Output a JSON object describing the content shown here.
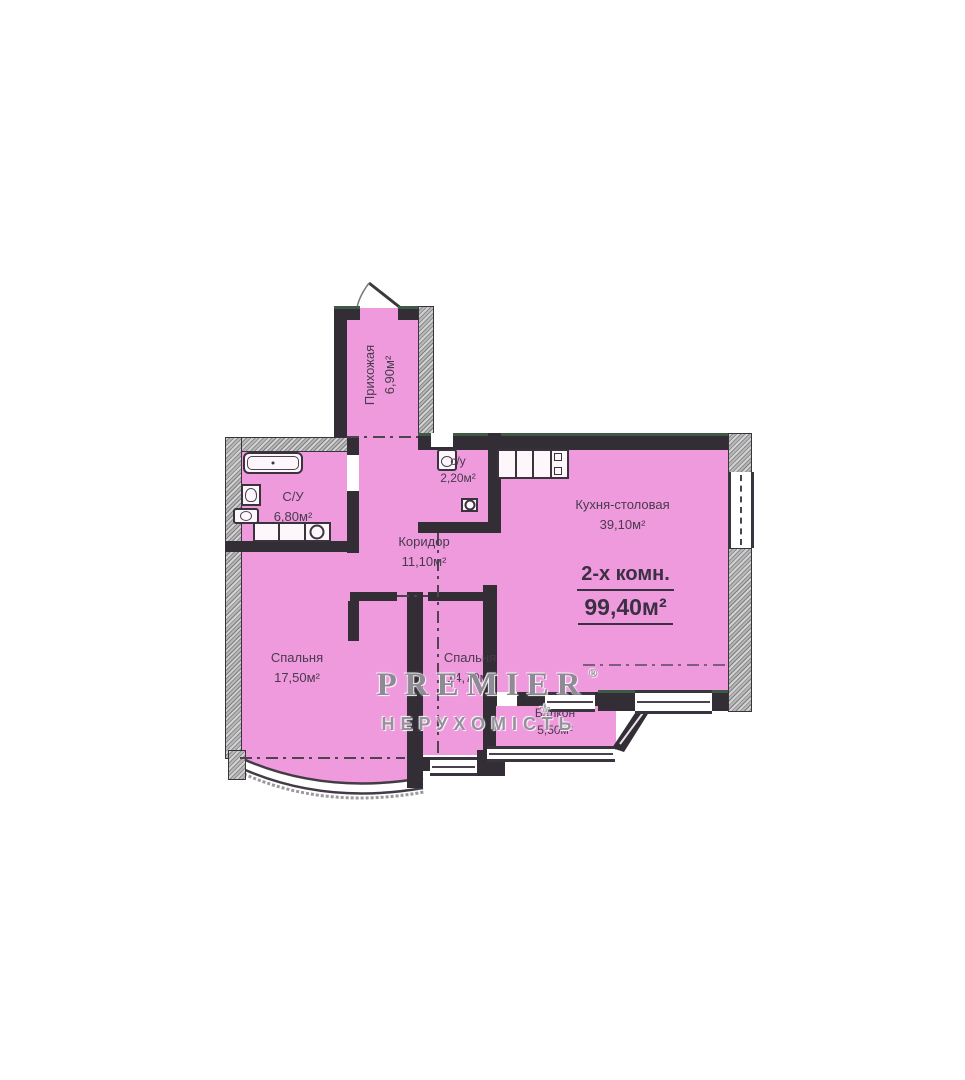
{
  "plan": {
    "summary": {
      "rooms_label": "2-х комн.",
      "total_area": "99,40м²"
    },
    "rooms": [
      {
        "key": "hallway",
        "name": "Прихожая",
        "area": "6,90м²"
      },
      {
        "key": "bathroom",
        "name": "С/У",
        "area": "6,80м²"
      },
      {
        "key": "wc",
        "name": "с/у",
        "area": "2,20м²"
      },
      {
        "key": "corridor",
        "name": "Коридор",
        "area": "11,10м²"
      },
      {
        "key": "kitchen-dining",
        "name": "Кухня-столовая",
        "area": "39,10м²"
      },
      {
        "key": "bedroom-left",
        "name": "Спальня",
        "area": "17,50м²"
      },
      {
        "key": "bedroom-middle",
        "name": "Спальня",
        "area": "14,70м²"
      },
      {
        "key": "balcony",
        "name": "Балкон",
        "area": "5,50м²"
      }
    ]
  },
  "watermark": {
    "brand": "PREMIER",
    "registered": "®",
    "subtitle": "НЕРУХОМІСТЬ",
    "ornament": "⚜"
  },
  "colors": {
    "room_fill": "#f09ade",
    "wall": "#332e36",
    "watermark_gray": "#8f8d96",
    "accent_green_edge": "#3e5a45"
  }
}
